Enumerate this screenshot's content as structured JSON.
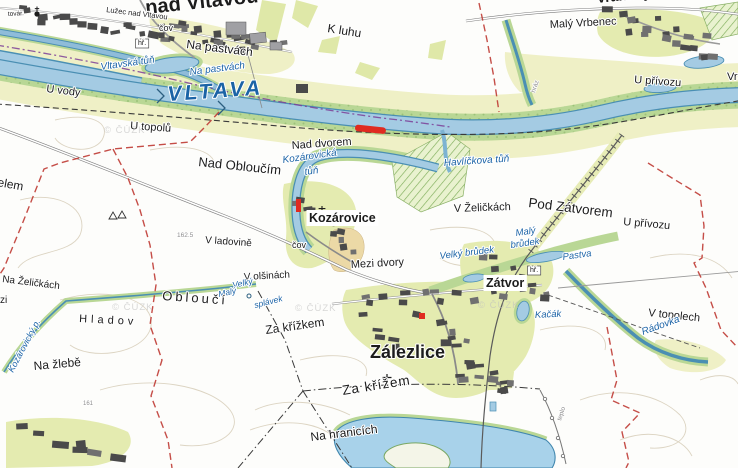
{
  "map": {
    "type": "topographic-cadastral-map",
    "watermark_text": "© ČÚZK",
    "colors": {
      "water": "#a4cbe3",
      "water_edge": "#4a8fb3",
      "riparian_green": "#b9d795",
      "field_yellow": "#eff0c6",
      "plot_yellow": "#e4ebb0",
      "orchard_tan": "#ecd9a6",
      "boundary_red": "#bf3b34",
      "boundary_purple": "#7d3f98",
      "highlight_red": "#e02b20",
      "label_blue": "#1b63a6",
      "building_gray": "#4a4a4a"
    },
    "highlight": {
      "description": "red highlighted road segment on river levee",
      "color": "#e02b20"
    },
    "labels": [
      {
        "id": "nad-vltavou-town",
        "text": "nad Vltavou",
        "x": 146,
        "y": 14,
        "size": 20,
        "rot": -6,
        "cls": "bold"
      },
      {
        "id": "luzec-nad-vltavou",
        "text": "Lužec nad Vltavou",
        "x": 106,
        "y": 12,
        "size": 7.5,
        "rot": 7
      },
      {
        "id": "tovar",
        "text": "továr.",
        "x": 8,
        "y": 16,
        "size": 6.5,
        "rot": -3
      },
      {
        "id": "cov-north",
        "text": "čov",
        "x": 159,
        "y": 31,
        "size": 9
      },
      {
        "id": "na-pastvach-field",
        "text": "Na pastvách",
        "x": 186,
        "y": 48,
        "size": 12,
        "rot": 7
      },
      {
        "id": "k-luhu",
        "text": "K luhu",
        "x": 327,
        "y": 32,
        "size": 12,
        "rot": 9
      },
      {
        "id": "maly-vrbenec",
        "text": "Malý Vrbenec",
        "x": 550,
        "y": 28,
        "size": 11,
        "rot": -3
      },
      {
        "id": "vranany-partial",
        "text": "Vraňany",
        "x": 597,
        "y": 3,
        "size": 14,
        "rot": -6,
        "cls": "bold"
      },
      {
        "id": "u-vody",
        "text": "U vody",
        "x": 46,
        "y": 92,
        "size": 11,
        "rot": 7
      },
      {
        "id": "u-privozu-north",
        "text": "U přívozu",
        "x": 634,
        "y": 83,
        "size": 11,
        "rot": 4
      },
      {
        "id": "vra-partial",
        "text": "Vra",
        "x": 727,
        "y": 80,
        "size": 11
      },
      {
        "id": "vltava",
        "text": "VLTAVA",
        "x": 168,
        "y": 101,
        "size": 21,
        "rot": -4,
        "ls": 3,
        "cls": "blue-big"
      },
      {
        "id": "vltavska-tun",
        "text": "Vltavská tůň",
        "x": 101,
        "y": 70,
        "size": 10,
        "rot": -8,
        "cls": "blue"
      },
      {
        "id": "na-pastvach-blue",
        "text": "Na pastvách",
        "x": 190,
        "y": 75,
        "size": 10,
        "rot": -7,
        "cls": "blue"
      },
      {
        "id": "u-topolu",
        "text": "U topolů",
        "x": 130,
        "y": 129,
        "size": 11,
        "rot": 4
      },
      {
        "id": "nad-dvorem",
        "text": "Nad dvorem",
        "x": 292,
        "y": 149,
        "size": 11,
        "rot": -4
      },
      {
        "id": "nad-obloucim",
        "text": "Nad Obloučím",
        "x": 198,
        "y": 166,
        "size": 13,
        "rot": 6
      },
      {
        "id": "kozarovicka-tun-1",
        "text": "Kozárovická",
        "x": 283,
        "y": 163,
        "size": 10,
        "rot": -8,
        "cls": "blue"
      },
      {
        "id": "kozarovicka-tun-2",
        "text": "tůň",
        "x": 305,
        "y": 175,
        "size": 10,
        "rot": -8,
        "cls": "blue"
      },
      {
        "id": "havlickova-tun",
        "text": "Havlíčkova tůň",
        "x": 444,
        "y": 166,
        "size": 10,
        "rot": -4,
        "cls": "blue"
      },
      {
        "id": "pod-zatvorem",
        "text": "Pod Zátvorem",
        "x": 528,
        "y": 207,
        "size": 13.5,
        "rot": 7
      },
      {
        "id": "u-privozu-east",
        "text": "U přívozu",
        "x": 623,
        "y": 225,
        "size": 11,
        "rot": 5
      },
      {
        "id": "v-zelickach",
        "text": "V Želičkách",
        "x": 454,
        "y": 212,
        "size": 11,
        "rot": -2
      },
      {
        "id": "v-ladovine",
        "text": "V ladovině",
        "x": 205,
        "y": 243,
        "size": 10,
        "rot": 4
      },
      {
        "id": "elev-162",
        "text": "162.5",
        "x": 177,
        "y": 237,
        "size": 6.5,
        "cls": "gray"
      },
      {
        "id": "kozarovice",
        "text": "Kozárovice",
        "x": 309,
        "y": 222,
        "size": 12.5,
        "cls": "bold",
        "box": "plain"
      },
      {
        "id": "cov-kozarovice",
        "text": "čov",
        "x": 292,
        "y": 248,
        "size": 9
      },
      {
        "id": "maly-brudek-1",
        "text": "Malý",
        "x": 516,
        "y": 236,
        "size": 9.5,
        "rot": -8,
        "cls": "blue"
      },
      {
        "id": "maly-brudek-2",
        "text": "brůdek",
        "x": 511,
        "y": 248,
        "size": 9.5,
        "rot": -8,
        "cls": "blue"
      },
      {
        "id": "pastva",
        "text": "Pastva",
        "x": 563,
        "y": 260,
        "size": 9.5,
        "rot": -8,
        "cls": "blue"
      },
      {
        "id": "velky-brudek",
        "text": "Velký brůdek",
        "x": 440,
        "y": 259,
        "size": 9.5,
        "rot": -7,
        "cls": "blue"
      },
      {
        "id": "mezi-dvory",
        "text": "Mezi dvory",
        "x": 351,
        "y": 268,
        "size": 11,
        "rot": -3
      },
      {
        "id": "na-zelickach",
        "text": "Na Želičkách",
        "x": 2,
        "y": 282,
        "size": 10,
        "rot": 7
      },
      {
        "id": "zi-partial",
        "text": "zi",
        "x": 0,
        "y": 303,
        "size": 10
      },
      {
        "id": "elem-partial",
        "text": "elem",
        "x": -3,
        "y": 186,
        "size": 12,
        "rot": 10
      },
      {
        "id": "v-olsinach",
        "text": "V olšinách",
        "x": 244,
        "y": 280,
        "size": 10,
        "rot": -3
      },
      {
        "id": "velky-splavek",
        "text": "Velký",
        "x": 233,
        "y": 288,
        "size": 8.5,
        "rot": -12,
        "cls": "blue"
      },
      {
        "id": "maly-splavek",
        "text": "Malý",
        "x": 219,
        "y": 297,
        "size": 8.5,
        "rot": -12,
        "cls": "blue"
      },
      {
        "id": "splavek",
        "text": "splávek",
        "x": 255,
        "y": 308,
        "size": 8.5,
        "rot": -14,
        "cls": "blue"
      },
      {
        "id": "oblouci",
        "text": "Obloučí",
        "x": 162,
        "y": 300,
        "size": 13,
        "rot": 4,
        "ls": 3
      },
      {
        "id": "hladov",
        "text": "Hladov",
        "x": 79,
        "y": 322,
        "size": 11,
        "rot": 3,
        "ls": 4
      },
      {
        "id": "za-krizkem",
        "text": "Za křížkem",
        "x": 266,
        "y": 334,
        "size": 12,
        "rot": -8
      },
      {
        "id": "zatvor",
        "text": "Zátvor",
        "x": 486,
        "y": 287,
        "size": 12.5,
        "cls": "bold",
        "box": "plain"
      },
      {
        "id": "kacak",
        "text": "Kačák",
        "x": 535,
        "y": 318,
        "size": 9.5,
        "rot": -3,
        "cls": "blue"
      },
      {
        "id": "zalezlice",
        "text": "Zálezlice",
        "x": 370,
        "y": 358,
        "size": 18,
        "cls": "bold"
      },
      {
        "id": "v-topolech",
        "text": "V topolech",
        "x": 648,
        "y": 316,
        "size": 11,
        "rot": 6
      },
      {
        "id": "radovka",
        "text": "Rádovka",
        "x": 643,
        "y": 335,
        "size": 10,
        "rot": -20,
        "cls": "blue"
      },
      {
        "id": "na-zlebe",
        "text": "Na žlebě",
        "x": 34,
        "y": 370,
        "size": 12,
        "rot": -5
      },
      {
        "id": "kozarovicky-p",
        "text": "Kozárovický p.",
        "x": 13,
        "y": 373,
        "size": 9,
        "rot": -62,
        "cls": "blue"
      },
      {
        "id": "elev-161",
        "text": "161",
        "x": 83,
        "y": 405,
        "size": 6,
        "cls": "gray"
      },
      {
        "id": "za-krizem",
        "text": "Za křížem",
        "x": 343,
        "y": 395,
        "size": 13.5,
        "rot": -9,
        "ls": 1
      },
      {
        "id": "na-hranicich",
        "text": "Na hranicích",
        "x": 311,
        "y": 441,
        "size": 12,
        "rot": -7
      },
      {
        "id": "teplo",
        "text": "teplo",
        "x": 561,
        "y": 421,
        "size": 6.5,
        "rot": -72,
        "cls": "gray"
      },
      {
        "id": "hraz",
        "text": "hráz",
        "x": 535,
        "y": 93,
        "size": 6.5,
        "rot": -72,
        "cls": "gray"
      },
      {
        "id": "hr-luzec",
        "text": "hř.",
        "x": 138,
        "y": 45,
        "size": 7,
        "box": "frame"
      },
      {
        "id": "hr-zatvor",
        "text": "hř.",
        "x": 530,
        "y": 272,
        "size": 7,
        "box": "frame"
      },
      {
        "id": "wm-1",
        "text": "© ČÚZK",
        "x": 104,
        "y": 133,
        "size": 9.5,
        "cls": "wm"
      },
      {
        "id": "wm-2",
        "text": "© ČÚZK",
        "x": 112,
        "y": 310,
        "size": 9.5,
        "cls": "wm"
      },
      {
        "id": "wm-3",
        "text": "© ČÚZK",
        "x": 295,
        "y": 311,
        "size": 9.5,
        "cls": "wm"
      },
      {
        "id": "wm-4",
        "text": "© ČÚZK",
        "x": 478,
        "y": 308,
        "size": 9.5,
        "cls": "wm"
      }
    ]
  }
}
